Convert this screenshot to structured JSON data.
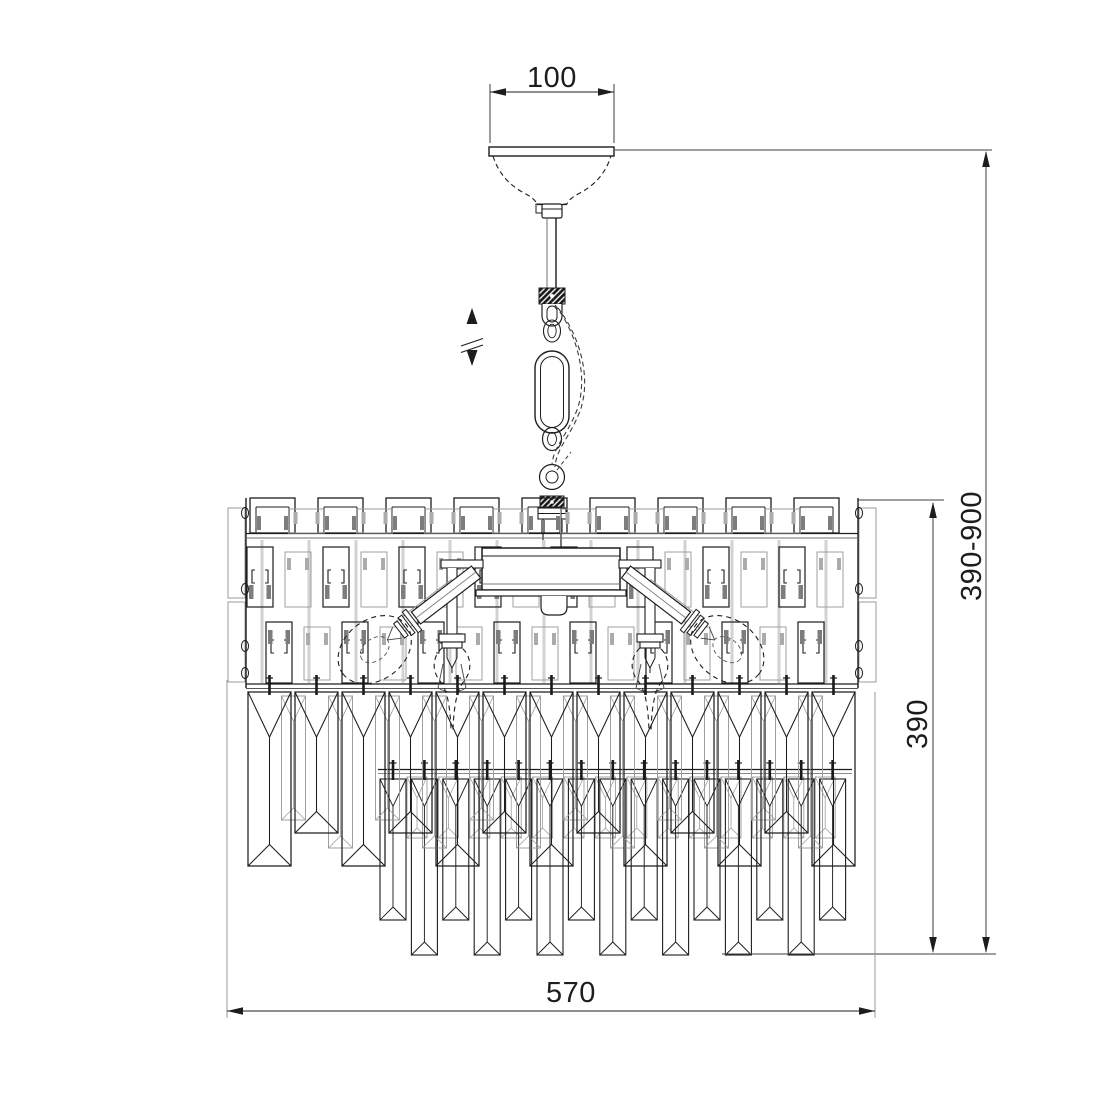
{
  "dimensions": {
    "canopy_width": "100",
    "overall_height_range": "390-900",
    "body_height": "390",
    "body_width": "570"
  },
  "style": {
    "background": "#ffffff",
    "line_color": "#1d1d1b",
    "faint_line_color": "#9b9b9b"
  }
}
